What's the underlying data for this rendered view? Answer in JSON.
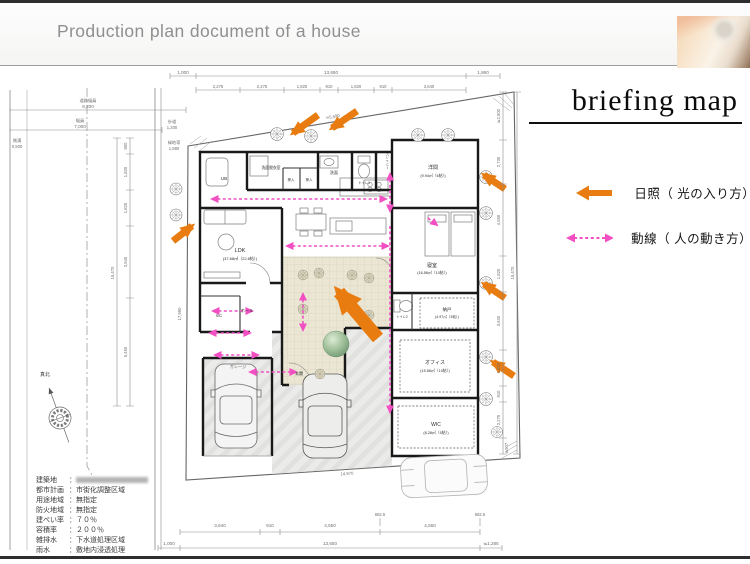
{
  "header": {
    "title": "Production plan document of a house"
  },
  "panel": {
    "title": "briefing map",
    "legend": [
      {
        "icon": "orange-solid-arrow-icon",
        "label": "日照（ 光の入り方）"
      },
      {
        "icon": "pink-dashed-arrow-icon",
        "label": "動線（ 人の動き方）"
      }
    ]
  },
  "colors": {
    "sunlight": "#e97c10",
    "circulation": "#f24fc3"
  },
  "site_info": {
    "rows": [
      {
        "label": "建築地",
        "value": ""
      },
      {
        "label": "都市計画",
        "value": "市街化調整区域"
      },
      {
        "label": "用途地域",
        "value": "無指定"
      },
      {
        "label": "防火地域",
        "value": "無指定"
      },
      {
        "label": "建ぺい率",
        "value": "７０％"
      },
      {
        "label": "容積率",
        "value": "２００％"
      },
      {
        "label": "雑排水",
        "value": "下水道処理区域"
      },
      {
        "label": "雨水",
        "value": "敷地内浸透処理"
      }
    ]
  },
  "plan": {
    "compass_label": "真北",
    "rooms": [
      {
        "name": "UB"
      },
      {
        "name": "洗面脱衣室"
      },
      {
        "name": "洗面"
      },
      {
        "name": "トイレ1"
      },
      {
        "name": "パントリー"
      },
      {
        "name": "押入"
      },
      {
        "name": "押入"
      },
      {
        "name": "洋間",
        "area": "(9.94㎡（6帖）)"
      },
      {
        "name": "寝室",
        "area": "(16.56㎡（10帖）)"
      },
      {
        "name": "LDK",
        "area": "(37.68㎡（22.8帖）)"
      },
      {
        "name": "ホール"
      },
      {
        "name": "SIC"
      },
      {
        "name": "玄関"
      },
      {
        "name": "トイレ2"
      },
      {
        "name": "納戸",
        "area": "(4.97㎡（3帖）)"
      },
      {
        "name": "オフィス",
        "area": "(15.56㎡（10帖）)"
      },
      {
        "name": "WIC",
        "area": "(8.28㎡（5帖）)"
      },
      {
        "name": "ガレージ"
      }
    ],
    "dims": {
      "top_total": [
        "1,000",
        "13,650",
        "1,860"
      ],
      "top_segs": [
        "2,275",
        "2,275",
        "1,820",
        "910",
        "1,820",
        "910",
        "3,640"
      ],
      "left_chain": [
        "800",
        "1,820",
        "1,820",
        "3,640",
        "5,460"
      ],
      "left_total": "15,470",
      "right_chain": [
        "≒2,500",
        "2,730",
        "4,550",
        "1,820",
        "3,640",
        "1,820",
        "910",
        "2,275"
      ],
      "right_total": "15,470",
      "right_corner": "≒907",
      "bottom_segs": [
        "3,640",
        "910",
        "4,550",
        "4,550"
      ],
      "bottom_offsets": [
        "682.5",
        "682.5"
      ],
      "bottom_total": [
        "1,000",
        "13,650",
        "≒1,285"
      ],
      "road": {
        "w1_label": "道路幅員",
        "w1": "8,200",
        "w2_label": "幅員",
        "w2": "7,000",
        "gutter_label": "側溝",
        "gutter": "0,500",
        "walk_label": "歩道",
        "walk": "1,200",
        "green_label": "緑地帯",
        "green": "1,880"
      },
      "boundary": {
        "top": "≒5,590",
        "bottom": "14,970",
        "left": "17,990"
      }
    }
  }
}
